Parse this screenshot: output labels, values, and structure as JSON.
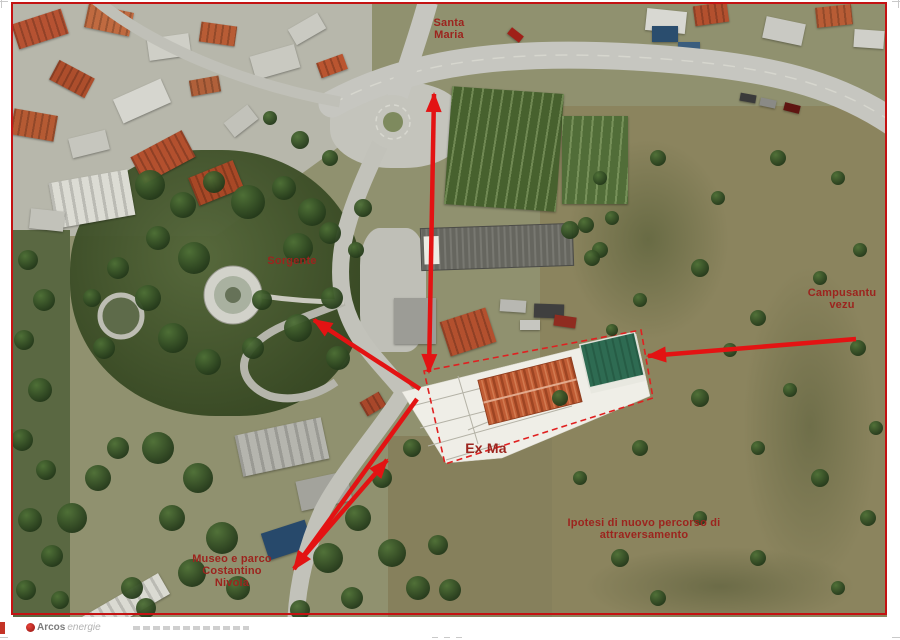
{
  "annotations": {
    "santa_maria": {
      "lines": [
        "Santa",
        "Maria"
      ]
    },
    "sorgente": {
      "lines": [
        "Sorgente"
      ]
    },
    "campusantu_vezu": {
      "lines": [
        "Campusantu",
        "vezu"
      ]
    },
    "ex_ma": {
      "lines": [
        "Ex Ma"
      ]
    },
    "ipotesi": {
      "lines": [
        "Ipotesi di nuovo percorso di",
        "attraversamento"
      ]
    },
    "museo_nivola": {
      "lines": [
        "Museo e parco",
        "Costantino",
        "Nivola"
      ]
    }
  },
  "footer": {
    "logo_bold": "Arcos",
    "logo_light": "energie"
  },
  "colors": {
    "arrow": "#e31313",
    "label": "#9c241e",
    "frame": "#c41212"
  }
}
